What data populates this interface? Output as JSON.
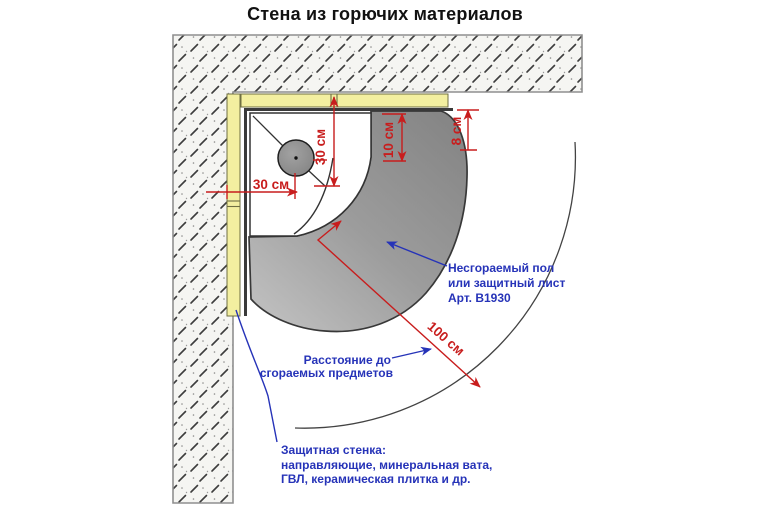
{
  "title": "Стена из горючих материалов",
  "dimensions": {
    "wall_to_flue_vertical": "30 см",
    "wall_to_flue_horizontal": "30 см",
    "side_clearance": "10 см",
    "rear_gap": "8 см",
    "radius_to_combustibles": "100 см"
  },
  "annotations": {
    "floor_plate": {
      "line1": "Несгораемый пол",
      "line2": "или защитный лист",
      "line3": "Арт. B1930"
    },
    "distance": {
      "line1": "Расстояние до",
      "line2": "сгораемых предметов"
    },
    "protective_wall": {
      "line1": "Защитная стенка:",
      "line2": "направляющие, минеральная вата,",
      "line3": "ГВЛ, керамическая плитка и др."
    }
  },
  "colors": {
    "dimension_red": "#c81d1d",
    "annotation_blue": "#2633b8",
    "protective_layer_yellow": "#f3efa0",
    "floor_plate_gray": "#979797",
    "wall_fill": "#f5f5f2"
  }
}
